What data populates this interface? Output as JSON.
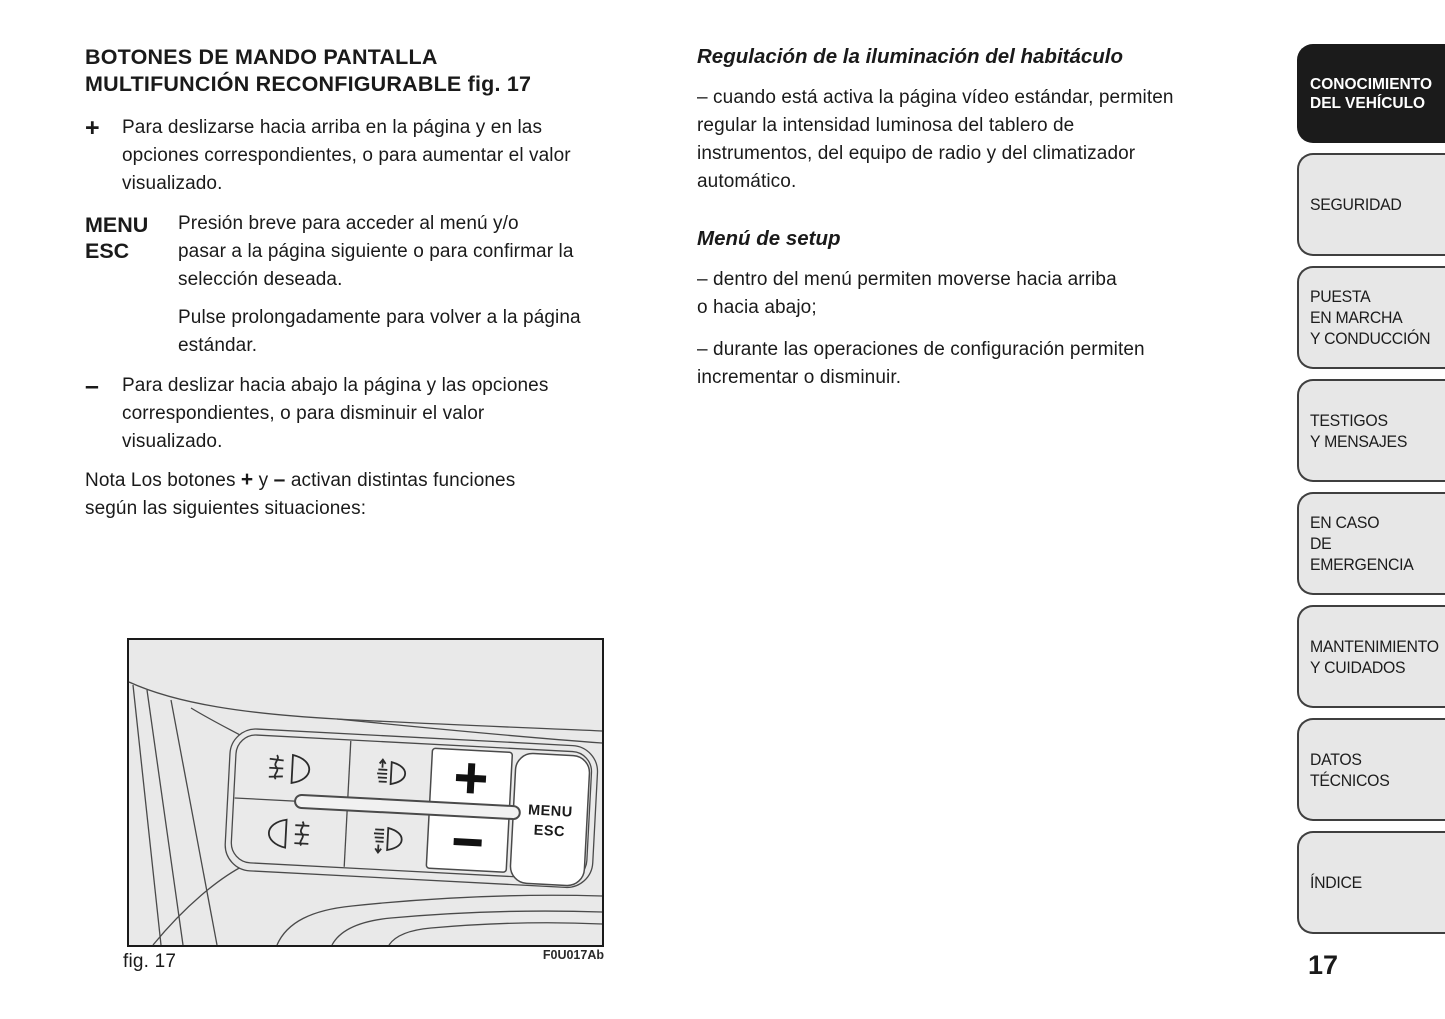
{
  "page": {
    "number": "17"
  },
  "left_column": {
    "heading": "BOTONES DE MANDO PANTALLA\nMULTIFUNCIÓN RECONFIGURABLE fig. 17",
    "plus_item": {
      "symbol": "+",
      "text": "Para deslizarse hacia arriba en la página y en las\nopciones correspondientes, o para aumentar el valor\nvisualizado."
    },
    "menu_item": {
      "symbol": "MENU\nESC",
      "text": "Presión breve para acceder al menú y/o\npasar a la página siguiente o para confirmar la\nselección deseada.",
      "text2": "Pulse prolongadamente para volver a la página\nestándar."
    },
    "minus_item": {
      "symbol": "–",
      "text": "Para deslizar hacia abajo la página y las opciones\ncorrespondientes, o para disminuir el valor\nvisualizado."
    },
    "note": {
      "part1": "Nota Los botones ",
      "plus": "+",
      "part2": " y ",
      "minus": "–",
      "part3": " activan distintas funciones\nsegún las siguientes situaciones:"
    }
  },
  "middle_column": {
    "section1": {
      "heading": "Regulación de la iluminación del habitáculo",
      "paragraph": "– cuando está activa la página vídeo estándar, permiten\nregular la intensidad luminosa del tablero de\ninstrumentos, del equipo de radio y del climatizador\nautomático."
    },
    "section2": {
      "heading": "Menú de setup",
      "paragraph1": "– dentro del menú permiten moverse hacia arriba\no hacia abajo;",
      "paragraph2": "– durante las operaciones de configuración permiten\nincrementar o disminuir."
    }
  },
  "sidebar": {
    "tabs": [
      {
        "label": "CONOCIMIENTO\nDEL VEHÍCULO",
        "active": true
      },
      {
        "label": "SEGURIDAD",
        "active": false
      },
      {
        "label": "PUESTA\nEN MARCHA\nY CONDUCCIÓN",
        "active": false
      },
      {
        "label": "TESTIGOS\nY MENSAJES",
        "active": false
      },
      {
        "label": "EN CASO\nDE EMERGENCIA",
        "active": false
      },
      {
        "label": "MANTENIMIENTO\nY CUIDADOS",
        "active": false
      },
      {
        "label": "DATOS TÉCNICOS",
        "active": false
      },
      {
        "label": "ÍNDICE",
        "active": false
      }
    ]
  },
  "figure": {
    "caption": "fig. 17",
    "code": "F0U017Ab",
    "plus_label": "+",
    "menu_label_line1": "MENU",
    "menu_label_line2": "ESC",
    "icons": [
      "front-fog-light-icon",
      "instrument-light-up-icon",
      "rear-fog-light-icon",
      "instrument-light-down-icon"
    ]
  },
  "colors": {
    "tab_active_bg": "#1b1b1b",
    "tab_inactive_bg": "#e7e7e7",
    "tab_border": "#3f3f3f",
    "figure_bg": "#e9e9e9",
    "text": "#1a1a1a"
  }
}
